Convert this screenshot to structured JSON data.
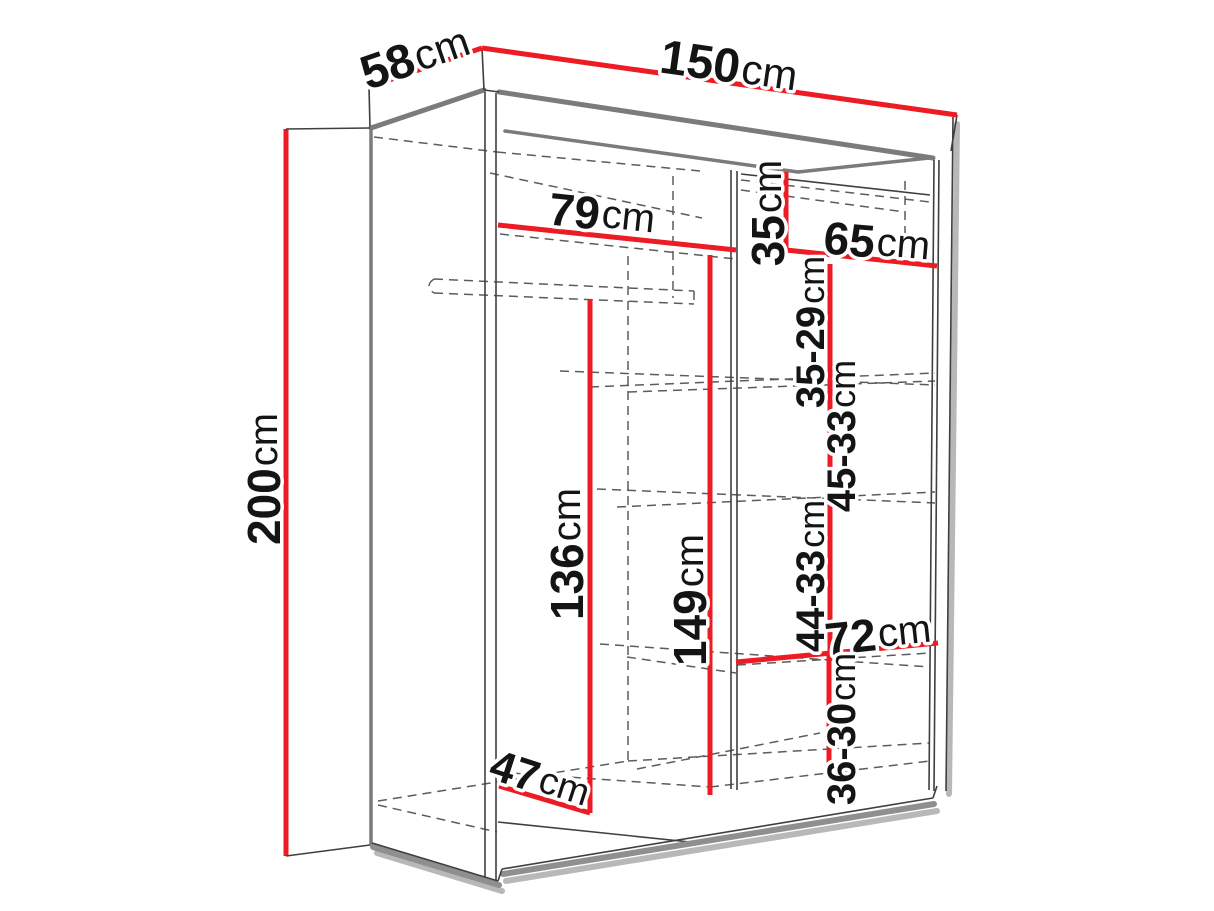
{
  "diagram": {
    "subject": "Sliding-door wardrobe perspective drawing with dimension lines",
    "unit": "cm",
    "colors": {
      "dimension_line": "#ed1b24",
      "outline": "#7b7b7b",
      "text": "#141414",
      "background": "#ffffff"
    },
    "dimensions": {
      "depth": {
        "value": "58",
        "unit": "cm"
      },
      "width": {
        "value": "150",
        "unit": "cm"
      },
      "height": {
        "value": "200",
        "unit": "cm"
      },
      "left_top_section_width": {
        "value": "79",
        "unit": "cm"
      },
      "top_right_shelf_height": {
        "value": "35",
        "unit": "cm"
      },
      "right_top_section_width": {
        "value": "65",
        "unit": "cm"
      },
      "right_shelf_gap_1": {
        "value": "35-29",
        "unit": "cm"
      },
      "right_shelf_gap_2": {
        "value": "45-33",
        "unit": "cm"
      },
      "hanging_space_height": {
        "value": "136",
        "unit": "cm"
      },
      "interior_height": {
        "value": "149",
        "unit": "cm"
      },
      "right_shelf_gap_3": {
        "value": "44-33",
        "unit": "cm"
      },
      "bottom_right_shelf_width": {
        "value": "72",
        "unit": "cm"
      },
      "right_shelf_gap_4": {
        "value": "36-30",
        "unit": "cm"
      },
      "interior_floor_depth": {
        "value": "47",
        "unit": "cm"
      }
    }
  }
}
